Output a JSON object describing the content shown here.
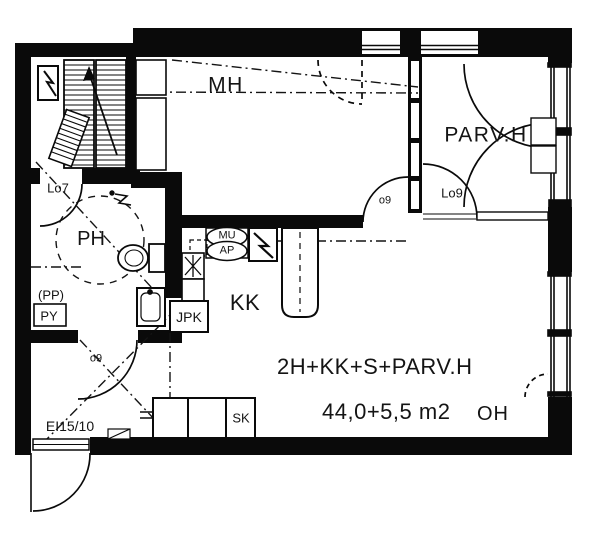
{
  "drawing": {
    "rooms": {
      "bedroom": "MH",
      "glazed_balcony": "PARV.H",
      "bathroom": "PH",
      "kitchenette": "KK",
      "living_room": "OH"
    },
    "doors": {
      "lo7": "Lo7",
      "lo9": "Lo9",
      "o9_bedroom": "o9",
      "o9_bathroom": "o9",
      "entry_fire_rating": "EI15/10"
    },
    "fixtures": {
      "microwave": "MU",
      "dishwasher": "AP",
      "fridge_freezer": "JPK",
      "cleaning_closet": "SK",
      "washing_machine": "PY",
      "washer_reservation": "(PP)"
    },
    "summary": {
      "apartment_type": "2H+KK+S+PARV.H",
      "area": "44,0+5,5 m2"
    },
    "colors": {
      "ink": "#0a0a0a",
      "paper": "#ffffff"
    }
  }
}
